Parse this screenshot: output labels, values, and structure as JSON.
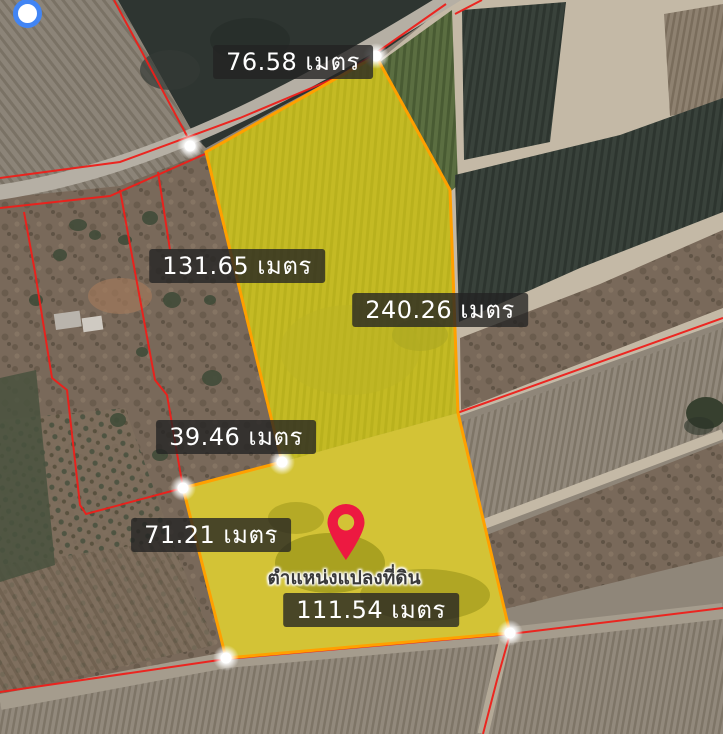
{
  "map": {
    "kind": "satellite-parcel-view",
    "measurements": [
      {
        "side": "top",
        "label": "76.58 เมตร"
      },
      {
        "side": "left-upper",
        "label": "131.65 เมตร"
      },
      {
        "side": "right",
        "label": "240.26 เมตร"
      },
      {
        "side": "middle",
        "label": "39.46 เมตร"
      },
      {
        "side": "left-lower",
        "label": "71.21 เมตร"
      },
      {
        "side": "bottom",
        "label": "111.54 เมตร"
      }
    ],
    "pin": {
      "icon": "map-pin-icon",
      "caption": "ตำแหน่งแปลงที่ดิน",
      "color": "#ed1941"
    },
    "parcel": {
      "fill_color": "#ffe600",
      "outline_color": "#ffa000",
      "vertex_marker": "white-dot",
      "vertex_count": 6
    },
    "cadastral": {
      "line_color": "#ee1f1a"
    },
    "gps": {
      "icon": "gps-location-icon",
      "ring_color": "#4285f4",
      "center_color": "#ffffff"
    },
    "label_style": {
      "background": "rgba(35,35,35,0.78)",
      "text_color": "#ffffff"
    }
  }
}
